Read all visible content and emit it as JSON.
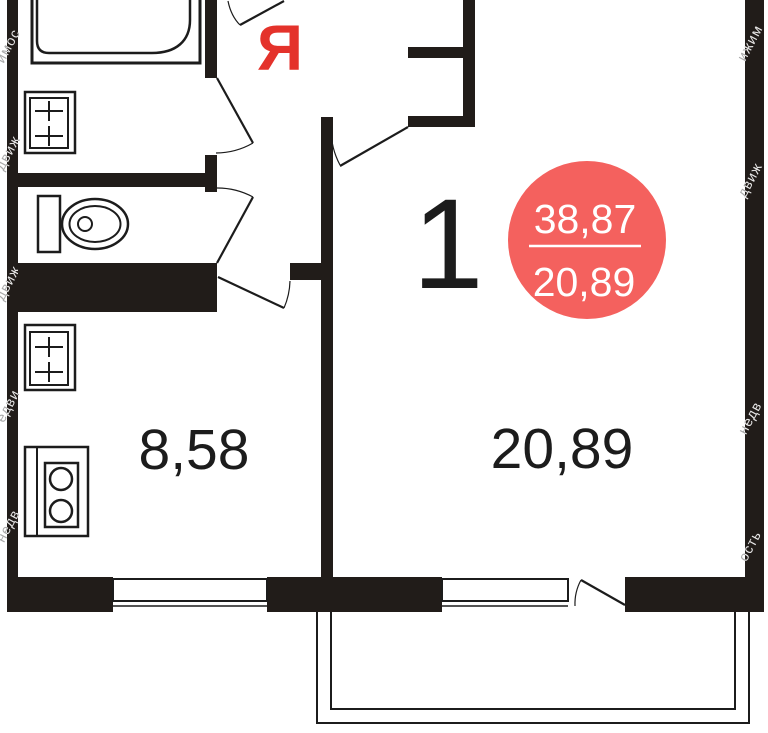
{
  "plan": {
    "unit_number": "1",
    "badge": {
      "total_area": "38,87",
      "living_area": "20,89"
    },
    "rooms": {
      "kitchen_area": "8,58",
      "living_area": "20,89"
    },
    "logo_letter": "Я",
    "watermark": {
      "full_text": "Недвижимость",
      "fragments": [
        "имос",
        "движ",
        "движ",
        "едви",
        "недв",
        "ижим",
        "движ",
        "недв",
        "ость"
      ]
    },
    "colors": {
      "wall": "#211c19",
      "line": "#1c1c1c",
      "label": "#1c1c1c",
      "badge_bg": "#f4615e",
      "badge_text": "#ffffff",
      "accent_red": "#e4322b",
      "background": "#ffffff"
    }
  }
}
